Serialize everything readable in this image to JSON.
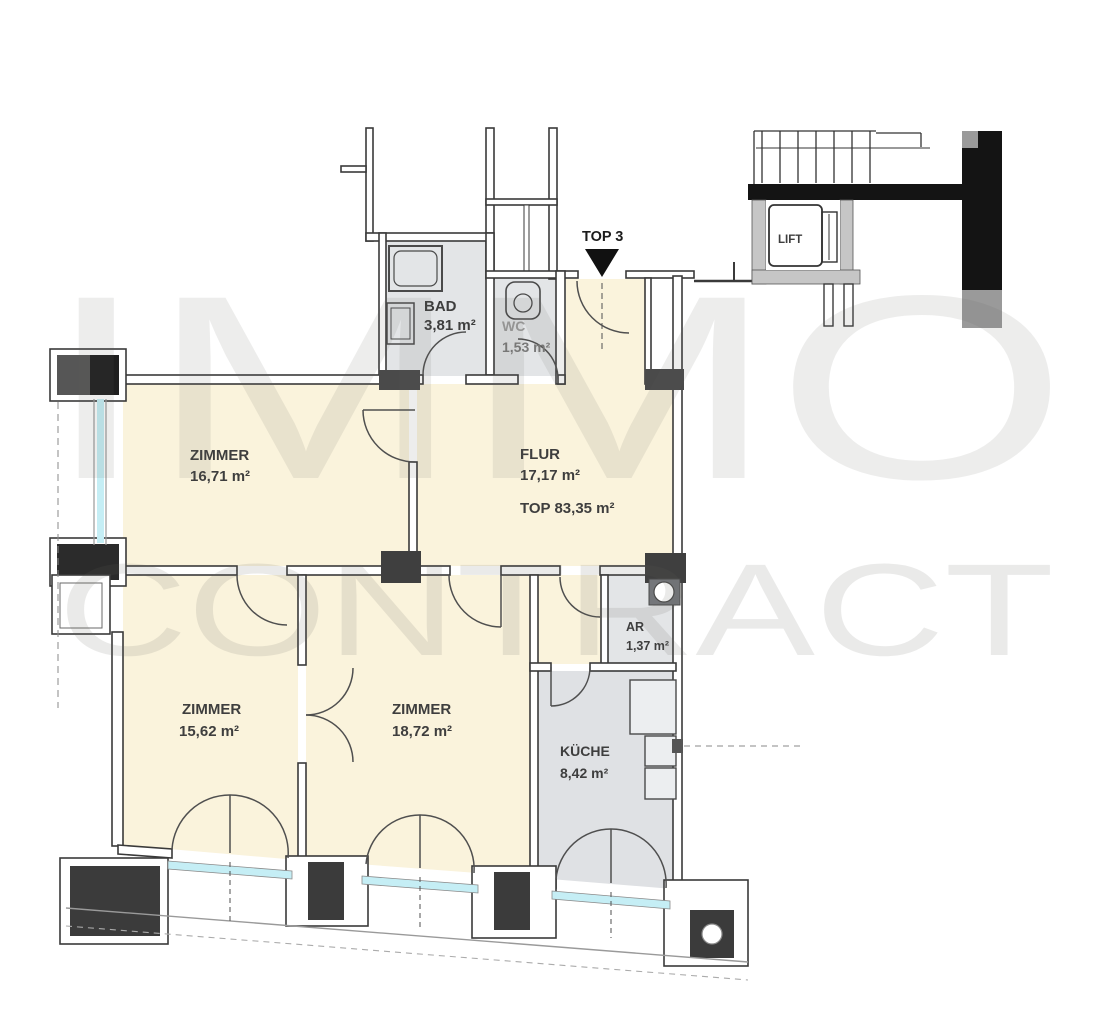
{
  "watermark": {
    "line1": "IMMO",
    "line2": "CONTRACT"
  },
  "plan": {
    "entrance": {
      "label": "TOP 3"
    },
    "lift": {
      "label": "LIFT"
    },
    "total_area": "TOP 83,35 m²",
    "rooms": [
      {
        "name": "BAD",
        "area": "3,81 m²"
      },
      {
        "name": "WC",
        "area": "1,53 m²"
      },
      {
        "name": "ZIMMER",
        "area": "16,71 m²"
      },
      {
        "name": "FLUR",
        "area": "17,17 m²"
      },
      {
        "name": "ZIMMER",
        "area": "15,62 m²"
      },
      {
        "name": "ZIMMER",
        "area": "18,72 m²"
      },
      {
        "name": "AR",
        "area": "1,37 m²"
      },
      {
        "name": "KÜCHE",
        "area": "8,42 m²"
      }
    ],
    "colors": {
      "room_fill": "#FAF3DC",
      "wet_room_fill": "#E3E5E7",
      "kitchen_fill": "#DFE1E4",
      "window_glass": "#C5EEF5",
      "wall": "#3A3A3A",
      "solid_wall": "#141414",
      "watermark": "#E9E9E6"
    }
  }
}
